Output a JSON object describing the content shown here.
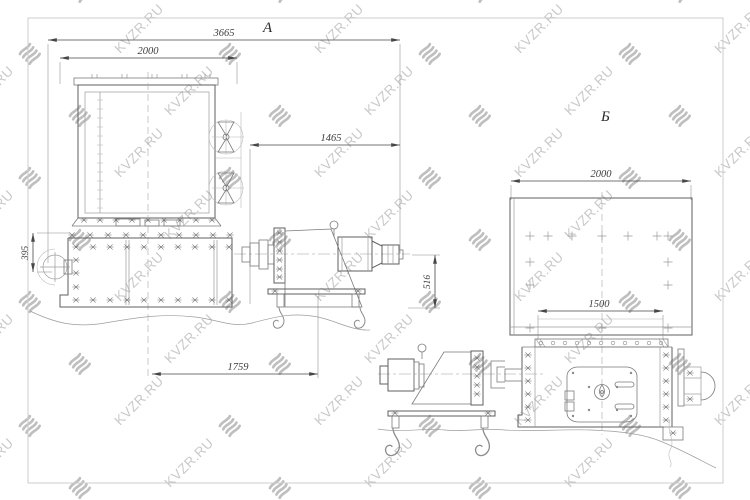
{
  "watermark": {
    "text": "KVZR.RU"
  },
  "views": {
    "view_a": {
      "label": "А",
      "dimensions": {
        "total_length": "3665",
        "cooler_width": "2000",
        "drive_section_length": "1465",
        "drive_height": "516",
        "side_offset": "395",
        "base_span": "1759"
      }
    },
    "view_b": {
      "label": "Б",
      "dimensions": {
        "panel_width": "2000",
        "housing_width": "1500"
      }
    }
  },
  "colors": {
    "background": "#ffffff",
    "frame": "#cccccc",
    "drawing_line": "#5f5f5f",
    "light_line": "#9d9d9d",
    "dimension_line": "#474747",
    "watermark_text": "#c9c9c9",
    "watermark_icon": "#bfbfbf"
  }
}
